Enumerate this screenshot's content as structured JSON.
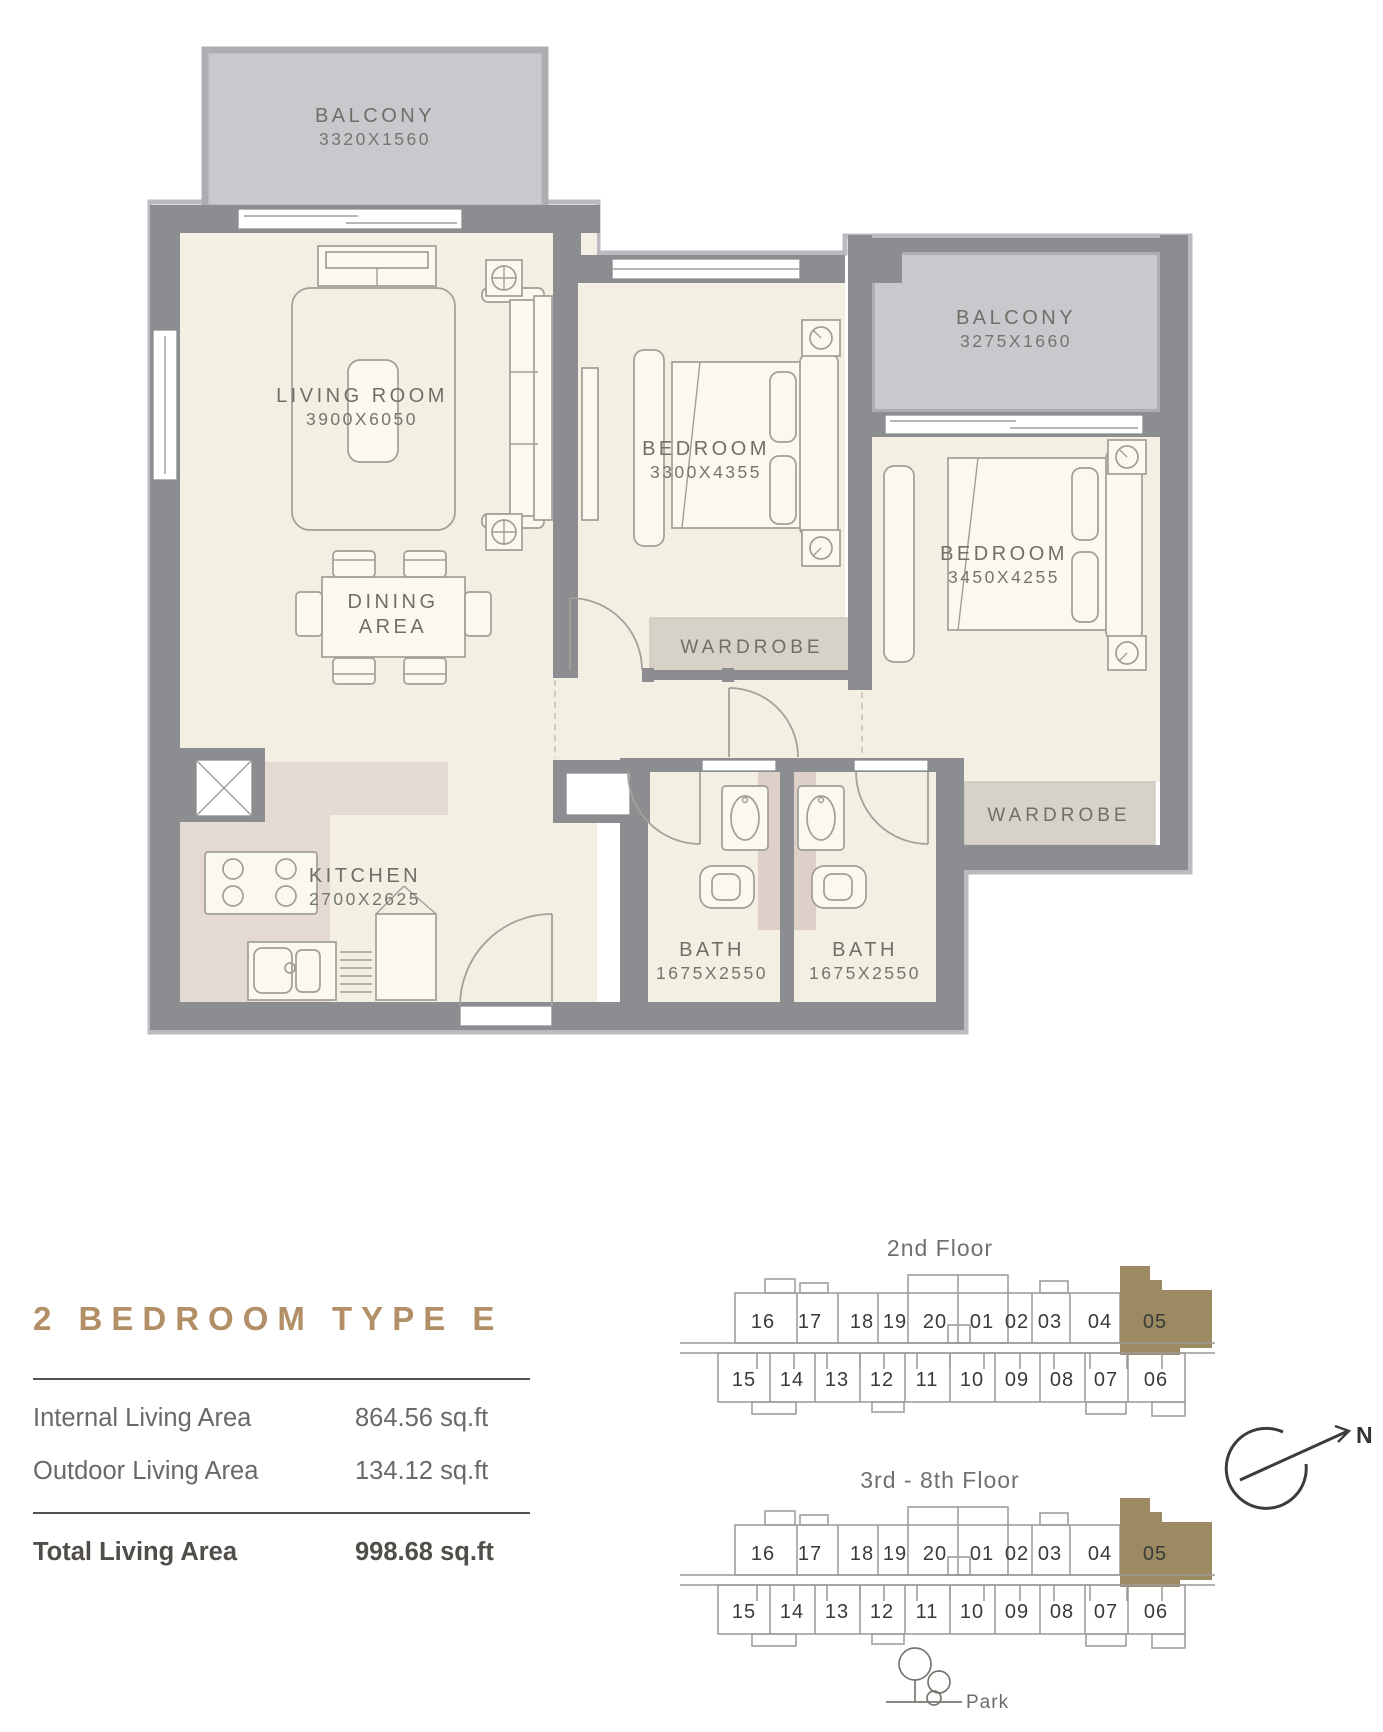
{
  "title_block": {
    "title": "2 BEDROOM TYPE E",
    "areas": [
      {
        "label": "Internal Living Area",
        "value": "864.56 sq.ft"
      },
      {
        "label": "Outdoor Living Area",
        "value": "134.12 sq.ft"
      }
    ],
    "total": {
      "label": "Total Living Area",
      "value": "998.68 sq.ft"
    }
  },
  "floor_plan": {
    "balcony_top": {
      "name": "BALCONY",
      "dims": "3320X1560"
    },
    "living_room": {
      "name": "LIVING ROOM",
      "dims": "3900X6050"
    },
    "dining_area": {
      "line1": "DINING",
      "line2": "AREA"
    },
    "bedroom_1": {
      "name": "BEDROOM",
      "dims": "3300X4355"
    },
    "balcony_right": {
      "name": "BALCONY",
      "dims": "3275X1660"
    },
    "bedroom_2": {
      "name": "BEDROOM",
      "dims": "3450X4255"
    },
    "wardrobe_1": {
      "name": "WARDROBE"
    },
    "wardrobe_2": {
      "name": "WARDROBE"
    },
    "kitchen": {
      "name": "KITCHEN",
      "dims": "2700X2625"
    },
    "bath_1": {
      "name": "BATH",
      "dims": "1675X2550"
    },
    "bath_2": {
      "name": "BATH",
      "dims": "1675X2550"
    }
  },
  "key_plans": {
    "diagram_1_label": "2nd Floor",
    "diagram_2_label": "3rd - 8th Floor",
    "top_row_units": [
      "16",
      "17",
      "18",
      "19",
      "20",
      "01",
      "02",
      "03",
      "04",
      "05"
    ],
    "bottom_row_units": [
      "15",
      "14",
      "13",
      "12",
      "11",
      "10",
      "09",
      "08",
      "07",
      "06"
    ],
    "highlighted_unit": "05",
    "park_label": "Park",
    "north_label": "N"
  },
  "colors": {
    "accent_gold": "#b28f66",
    "unit_highlight": "#9c8b62",
    "wall_gray": "#8b8d90",
    "balcony_fill": "#c9c8cd",
    "floor_cream": "#f4efe3"
  }
}
